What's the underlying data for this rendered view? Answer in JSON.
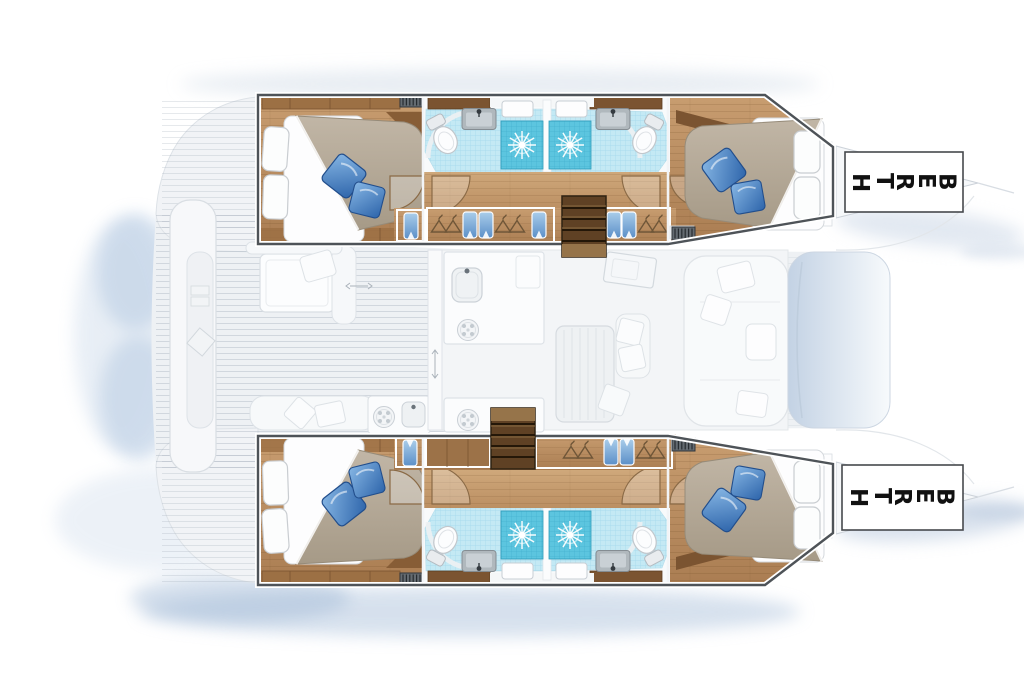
{
  "title": "Catamaran accommodation plan",
  "diagram": {
    "kind": "yacht-floor-plan",
    "orientation": "bow-right",
    "labels": {
      "berth_port": "BERTH",
      "berth_starboard": "BERTH"
    },
    "hulls": [
      {
        "side": "port-top",
        "rooms": [
          "aft-double-cabin",
          "aft-bathroom-with-shower",
          "wardrobe-lockers",
          "companionway-stairs",
          "forward-bathroom-with-shower",
          "forward-double-cabin",
          "bow-berth"
        ]
      },
      {
        "side": "starboard-bottom",
        "rooms": [
          "aft-double-cabin",
          "aft-bathroom-with-shower",
          "companionway-stairs",
          "wardrobe-lockers",
          "forward-bathroom-with-shower",
          "forward-double-cabin",
          "bow-berth"
        ]
      }
    ],
    "bridgedeck": [
      "aft-platform",
      "cockpit-table-and-seating",
      "outdoor-galley-module",
      "salon-galley",
      "dining-table",
      "sofa",
      "forward-lounge-pad"
    ],
    "counts": {
      "double_beds": 4,
      "bathrooms": 4,
      "showers": 4,
      "toilets": 4,
      "sinks": 4,
      "stairways": 2,
      "berth_labels": 2
    }
  },
  "colors": {
    "background": "#ffffff",
    "outline": "#4e5358",
    "wood_floor": "#bc9168",
    "wood_dark": "#7b5431",
    "stairs": "#5f4124",
    "duvet": "#b3a896",
    "sheet": "#fdfdfe",
    "pillow_blue": "#3f76b8",
    "tile_floor": "#c4e9f4",
    "tile_shower": "#5cc5df",
    "fixture_gray": "#b0b8bd",
    "shadow_blue": "#b9cce2",
    "faded_deck": "#eef1f4",
    "label_bg": "#ffffff",
    "label_border": "#46494d",
    "label_text": "#111111"
  }
}
